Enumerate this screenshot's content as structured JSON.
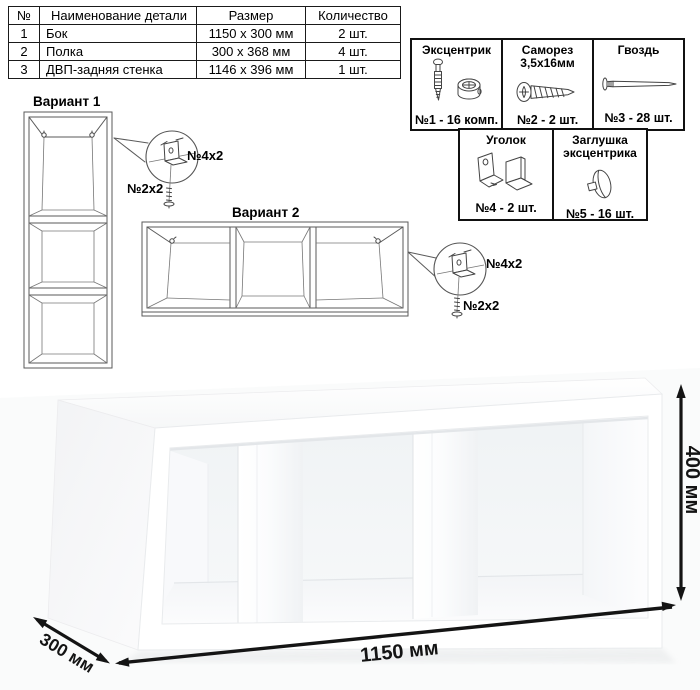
{
  "parts_table": {
    "headers": {
      "num": "№",
      "name": "Наименование детали",
      "size": "Размер",
      "qty": "Количество"
    },
    "rows": [
      {
        "num": "1",
        "name": "Бок",
        "size": "1150 x 300 мм",
        "qty": "2 шт."
      },
      {
        "num": "2",
        "name": "Полка",
        "size": "300 x 368 мм",
        "qty": "4 шт."
      },
      {
        "num": "3",
        "name": "ДВП-задняя стенка",
        "size": "1146 x 396 мм",
        "qty": "1 шт."
      }
    ]
  },
  "hardware": {
    "items": [
      {
        "title": "Эксцентрик",
        "count": "№1 - 16 комп."
      },
      {
        "title": "Саморез 3,5х16мм",
        "count": "№2 - 2 шт."
      },
      {
        "title": "Гвоздь",
        "count": "№3 - 28 шт."
      },
      {
        "title": "Уголок",
        "count": "№4 - 2 шт."
      },
      {
        "title": "Заглушка эксцентрика",
        "count": "№5 - 16 шт."
      }
    ]
  },
  "variants": {
    "v1": {
      "title": "Вариант 1",
      "bracket_label": "№4х2",
      "screw_label": "№2х2"
    },
    "v2": {
      "title": "Вариант 2",
      "bracket_label": "№4х2",
      "screw_label": "№2х2"
    }
  },
  "dimensions": {
    "width": "1150 мм",
    "height": "400 мм",
    "depth": "300 мм"
  },
  "colors": {
    "line": "#5a5a5a",
    "border": "#111111",
    "shade": "#f0f2f4"
  }
}
